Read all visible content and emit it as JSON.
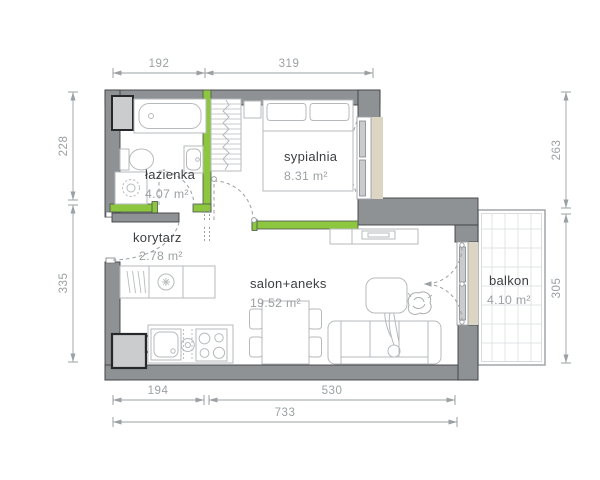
{
  "plan": {
    "type": "apartment-floor-plan",
    "rooms": [
      {
        "id": "lazienka",
        "name": "łazienka",
        "area": "4.07 m²"
      },
      {
        "id": "sypialnia",
        "name": "sypialnia",
        "area": "8.31 m²"
      },
      {
        "id": "korytarz",
        "name": "korytarz",
        "area": "2.78 m²"
      },
      {
        "id": "salon",
        "name": "salon+aneks",
        "area": "19.52 m²"
      },
      {
        "id": "balkon",
        "name": "balkon",
        "area": "4.10 m²"
      }
    ],
    "dimensions": {
      "top": [
        "192",
        "319"
      ],
      "left": [
        "228",
        "335"
      ],
      "right": [
        "263",
        "305"
      ],
      "bottom": [
        "194",
        "530"
      ],
      "overall": "733"
    },
    "colors": {
      "wall": "#8f9295",
      "partition_green": "#8dc63f",
      "window_sill": "#dcd5c4",
      "furniture_line": "#b7babc",
      "dimension_gray": "#9ba0a3",
      "label_dark": "#3b3e41",
      "shaft_fill": "#caccce"
    }
  }
}
